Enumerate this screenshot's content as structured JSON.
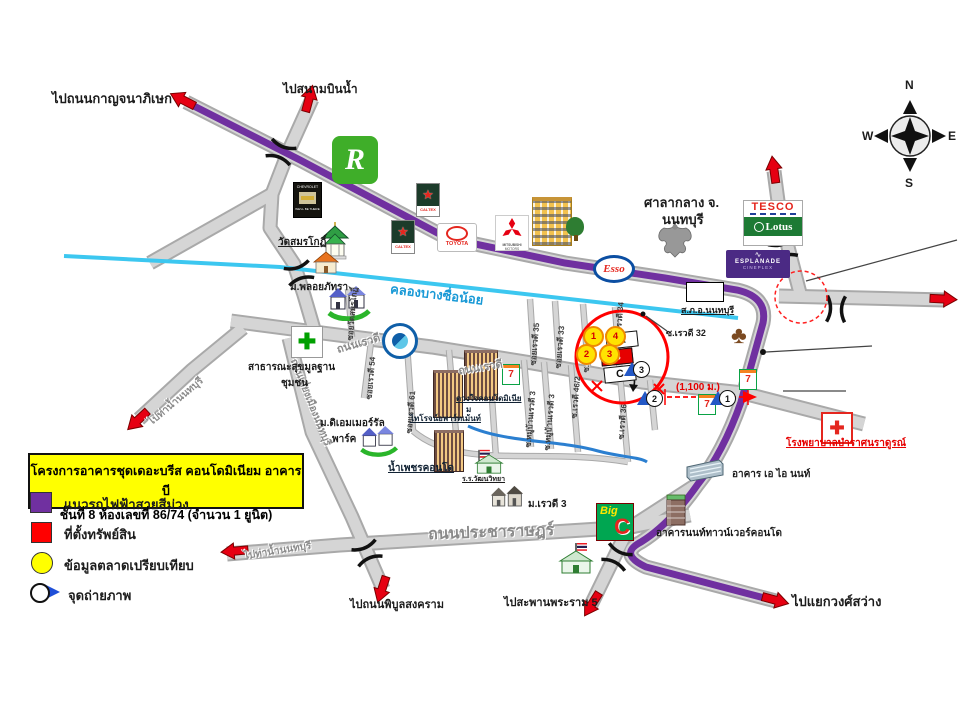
{
  "project_box": {
    "line1": "โครงการอาคารชุดเดอะบรีส คอนโดมิเนียม อาคาร บี",
    "line2": "ชั้นที่ 8 ห้องเลขที่ 86/74  (จำนวน 1 ยูนิต)"
  },
  "legend": {
    "purple_line": "แนวรถไฟฟ้าสายสีม่วง",
    "property": "ที่ตั้งทรัพย์สิน",
    "market_data": "ข้อมูลตลาดเปรียบเทียบ",
    "photo_point": "จุดถ่ายภาพ"
  },
  "compass": {
    "n": "N",
    "e": "E",
    "s": "S",
    "w": "W"
  },
  "destinations": {
    "kanchanaphisek": "ไปถนนกาญจนาภิเษก",
    "sanambinnam": "ไปสนามบินน้ำ",
    "tha_nam_nonthaburi": "ไปท่าน้ำนนทบุรี",
    "phibunsongkhram": "ไปถนนพิบูลสงคราม",
    "rama5_bridge": "ไปสะพานพระราม 5",
    "wongsawang": "ไปแยกวงศ์สว่าง"
  },
  "roads": {
    "rewadee": "ถนนเรวดี",
    "pracharat": "ถนนประชาราษฎร์",
    "bypass": "ถนนเลี่ยงเมืองนนทบุรี",
    "canal": "คลองบางซื่อน้อย"
  },
  "sois": {
    "wat": "ซอยวัดสมรโกฏิ์",
    "r54": "ซอยเรวดี 54",
    "r61": "ซอยเรวดี 61",
    "r35": "ซอยเรวดี 35",
    "r33": "ซอยเรวดี 33",
    "r44": "ซ.เรวดี 44",
    "r34": "ซ.เรวดี 34",
    "r36": "ซ.เรวดี 36",
    "r46_2": "ซ.เรวดี 46/2",
    "muban3": "ซ.หมู่บ้านเรวดี 3",
    "r32": "ซ.เรวดี 32"
  },
  "places": {
    "city_hall_1": "ศาลากลาง จ.",
    "city_hall_2": "นนทบุรี",
    "police_station": "ส.ภ.อ.นนทบุรี",
    "wat_samonkot": "วัดสมรโกฏิ์",
    "ploy_phattra": "ม.พลอยภัทรา",
    "health_1": "สาธารณะสุขมูลฐาน",
    "health_2": "ชุมชน",
    "emerald_1": "ม.ดิเอมเมอร์รัล",
    "emerald_2": "พาร์ค",
    "tairoj": "ไทโรจน์อพาร์ทเม้นท์",
    "duangjai_1": "ดวงใจคอนโดมิเนีย",
    "duangjai_2": "ม",
    "nampetch": "น้ำเพชรคอนโด",
    "school": "ร.ร.วัฒนวิทยา",
    "mu_rewadee3": "ม.เรวดี 3",
    "hospital": "โรงพยาบาลบำราศนราดูรณ์",
    "ai_nont": "อาคาร เอ ไอ นนท์",
    "nont_tower": "อาคารนนท์ทาวน์เวอร์คอนโด"
  },
  "measurement": {
    "distance": "(1,100 ม.)"
  },
  "markers": {
    "bldg_a": "A",
    "bldg_b": "B",
    "bldg_c": "C",
    "c1": "1",
    "c2": "2",
    "c3": "3",
    "c4": "4",
    "cam1": "1",
    "cam2": "2",
    "cam3": "3"
  },
  "brands": {
    "robinson": "R",
    "chevrolet": "CHEVROLET",
    "chevrolet_tag": "WE'LL BE THERE",
    "caltex": "CALTEX",
    "toyota": "TOYOTA",
    "mitsubishi": "MITSUBISHI",
    "mitsubishi2": "MOTORS",
    "esso": "Esso",
    "tesco": "TESCO",
    "lotus": "Lotus",
    "esplanade": "ESPLANADE",
    "cineplex": "CINEPLEX",
    "seven": "7",
    "bigc_big": "Big",
    "bigc_c": "C"
  },
  "icons": {
    "star": "★",
    "cross": "✚",
    "club": "♣"
  },
  "colors": {
    "purple_line": "#7030A0",
    "property_red": "#FF0000",
    "market_yellow": "#FFFF00",
    "canal_blue": "#3CC7F0"
  }
}
